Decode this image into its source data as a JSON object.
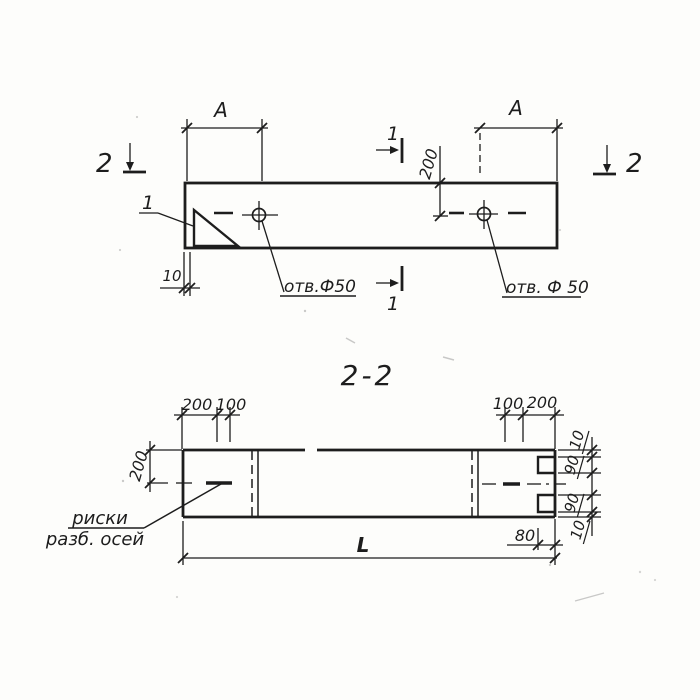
{
  "colors": {
    "paper": "#fdfdfb",
    "ink": "#1d1d1d"
  },
  "top_view": {
    "dim_a_left": "A",
    "dim_a_right": "A",
    "dim_200": "200",
    "dim_10": "10",
    "hole_label_left": "отв.Ф50",
    "hole_label_right": "отв. Ф 50",
    "detail_callout": "1",
    "section_1_top": "1",
    "section_1_bottom": "1",
    "section_2_left": "2",
    "section_2_right": "2"
  },
  "section_view": {
    "title": "2-2",
    "top_left_dims": [
      "200",
      "100"
    ],
    "top_right_dims": [
      "100",
      "200"
    ],
    "height_dim": "200",
    "right_chain_dims": [
      "10",
      "90",
      "90",
      "10"
    ],
    "notch_depth_dim": "80",
    "length_dim": "L",
    "axis_note_line1": "риски",
    "axis_note_line2": "разб. осей"
  }
}
